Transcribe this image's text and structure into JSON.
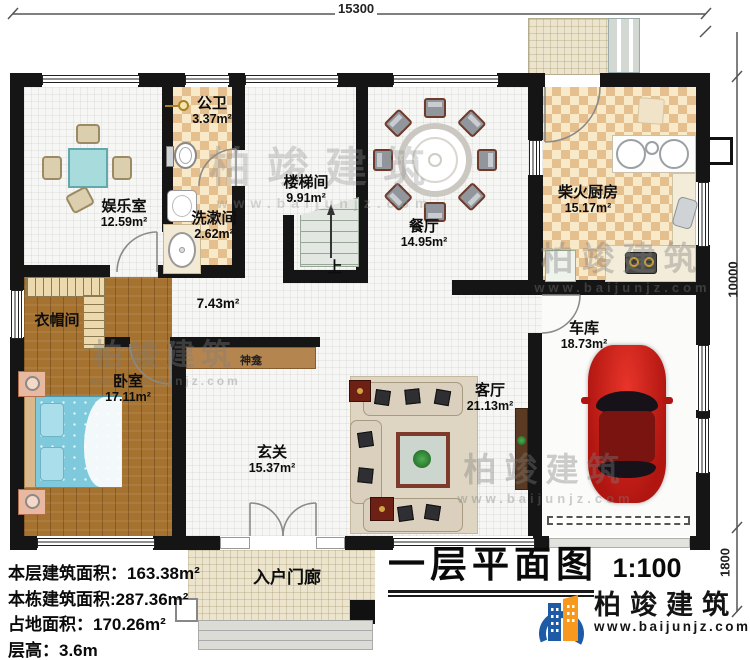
{
  "title_block": {
    "title": "一层平面图",
    "scale": "1:100"
  },
  "dimensions": {
    "width_top": "15300",
    "height_right": "10000",
    "porch_right": "1800"
  },
  "rooms": {
    "entertainment": {
      "name": "娱乐室",
      "area": "12.59m²"
    },
    "public_bath": {
      "name": "公卫",
      "area": "3.37m²"
    },
    "washroom": {
      "name": "洗漱间",
      "area": "2.62m²"
    },
    "stairwell": {
      "name": "楼梯间",
      "area": "9.91m²"
    },
    "dining": {
      "name": "餐厅",
      "area": "14.95m²"
    },
    "kitchen": {
      "name": "柴火厨房",
      "area": "15.17m²"
    },
    "cloakroom": {
      "name": "衣帽间"
    },
    "bedroom": {
      "name": "卧室",
      "area": "17.11m²"
    },
    "corridor": {
      "area": "7.43m²"
    },
    "foyer": {
      "name": "玄关",
      "area": "15.37m²"
    },
    "living": {
      "name": "客厅",
      "area": "21.13m²"
    },
    "garage": {
      "name": "车库",
      "area": "18.73m²"
    },
    "porch": {
      "name": "入户门廊"
    },
    "shrine": {
      "name": "神龛"
    },
    "stairs_up": "上"
  },
  "info_panel": {
    "lines": [
      "本层建筑面积：163.38m²",
      "本栋建筑面积:287.36m²",
      "占地面积：170.26m²",
      "层高：3.6m"
    ]
  },
  "branding": {
    "name": "柏竣建筑",
    "website": "www.baijunjz.com"
  },
  "watermark": {
    "name": "柏竣建筑",
    "website": "www.baijunjz.com"
  }
}
